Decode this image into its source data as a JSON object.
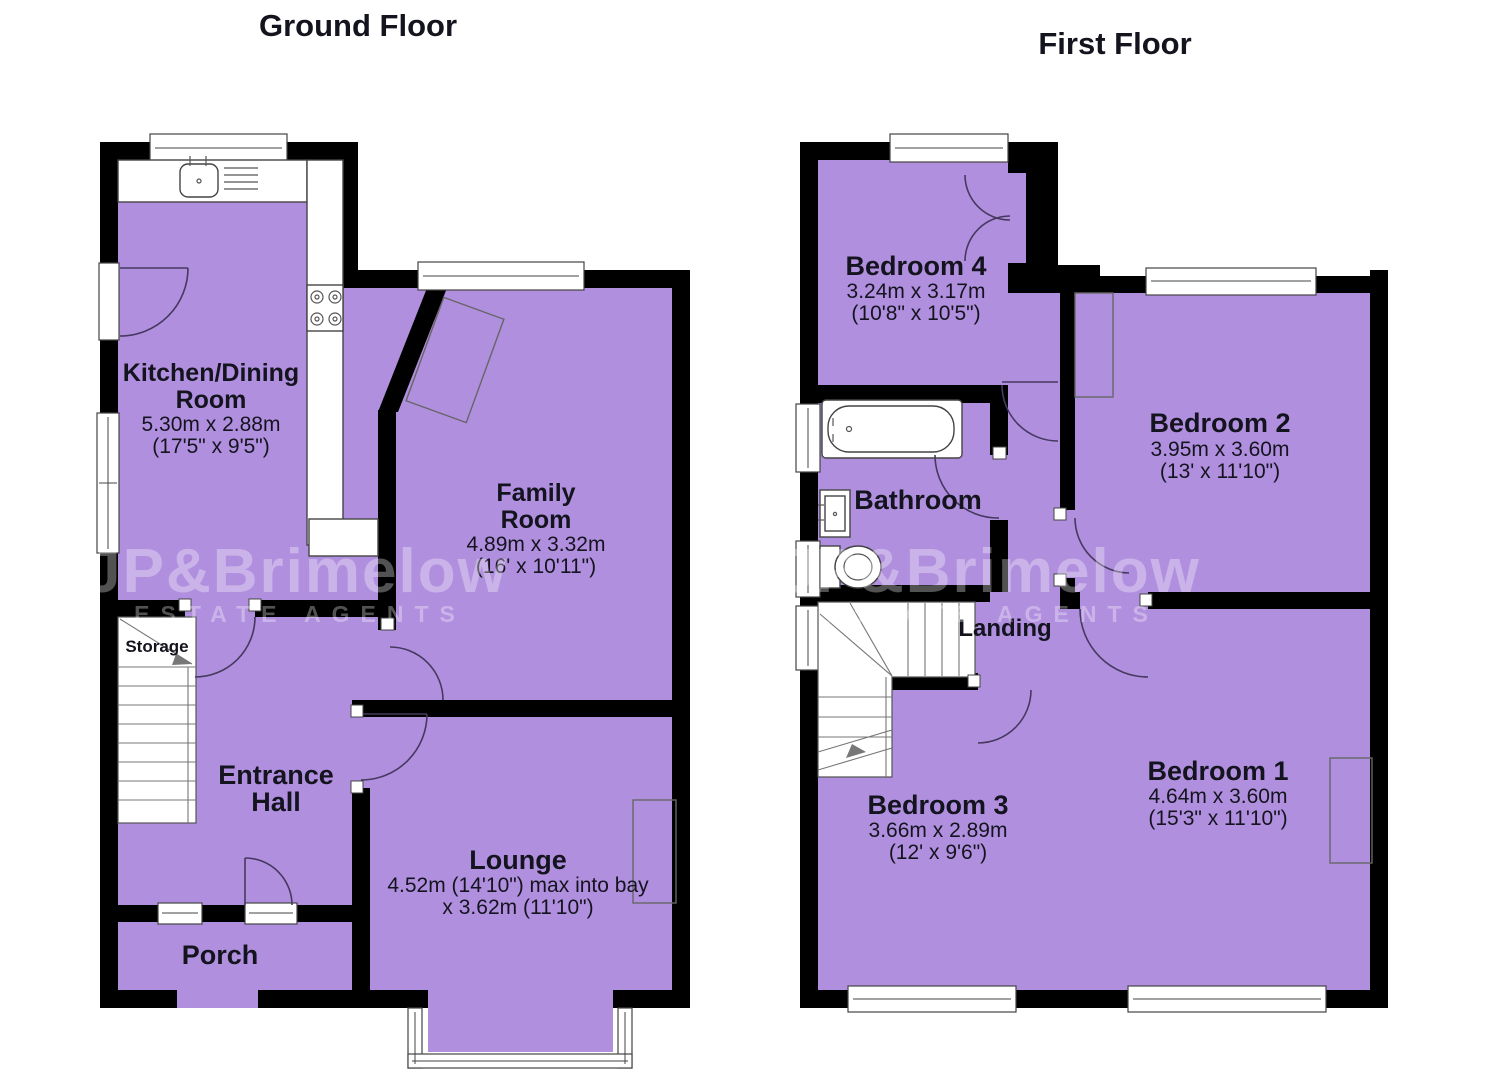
{
  "page": {
    "background": "#ffffff"
  },
  "colors": {
    "room_fill": "#B18FDF",
    "wall": "#000000",
    "door_arc": "#46395f",
    "text": "#14141f",
    "watermark_text": "rgba(255,255,255,0.32)"
  },
  "watermark": {
    "brand": "JP&Brimelow",
    "tagline": "ESTATE AGENTS"
  },
  "ground_floor": {
    "title": "Ground Floor",
    "rooms": {
      "kitchen": {
        "name_line1": "Kitchen/Dining",
        "name_line2": "Room",
        "dim_metric": "5.30m x 2.88m",
        "dim_imperial": "(17'5\" x 9'5\")"
      },
      "family": {
        "name_line1": "Family",
        "name_line2": "Room",
        "dim_metric": "4.89m x 3.32m",
        "dim_imperial": "(16' x 10'11\")"
      },
      "lounge": {
        "name": "Lounge",
        "dim_line1": "4.52m (14'10\") max into bay",
        "dim_line2": "x 3.62m (11'10\")"
      },
      "entrance_hall": {
        "name_line1": "Entrance",
        "name_line2": "Hall"
      },
      "porch": {
        "name": "Porch"
      },
      "storage": {
        "name": "Storage"
      }
    }
  },
  "first_floor": {
    "title": "First Floor",
    "rooms": {
      "bedroom4": {
        "name": "Bedroom 4",
        "dim_metric": "3.24m x 3.17m",
        "dim_imperial": "(10'8\" x 10'5\")"
      },
      "bedroom2": {
        "name": "Bedroom 2",
        "dim_metric": "3.95m x 3.60m",
        "dim_imperial": "(13' x 11'10\")"
      },
      "bedroom1": {
        "name": "Bedroom 1",
        "dim_metric": "4.64m x 3.60m",
        "dim_imperial": "(15'3\" x 11'10\")"
      },
      "bedroom3": {
        "name": "Bedroom 3",
        "dim_metric": "3.66m x 2.89m",
        "dim_imperial": "(12' x 9'6\")"
      },
      "bathroom": {
        "name": "Bathroom"
      },
      "landing": {
        "name": "Landing"
      }
    }
  }
}
